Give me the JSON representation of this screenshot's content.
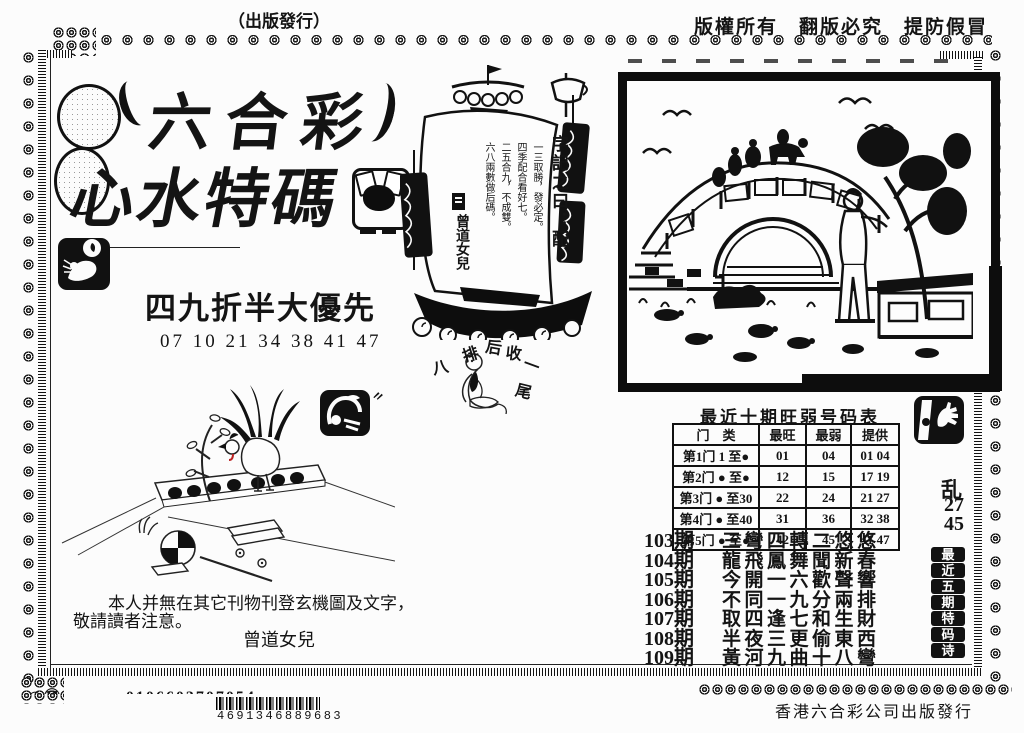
{
  "header": {
    "top_left": "（出版發行）",
    "top_right": "版權所有　翻版必究　提防假冒"
  },
  "masthead": {
    "title_line1": "六合彩",
    "title_line2": "心水特碼"
  },
  "promo": {
    "headline": "四九折半大優先",
    "numbers": "07 10 21 34 38 41 47"
  },
  "sail_message": {
    "heading": "字記之曰：配",
    "line1": "一三取勝，發必定。",
    "line2": "四季配合看好七。",
    "line3": "二五合九，不成雙。",
    "line4": "六八兩數做后碼。",
    "signature": "曾道女兒"
  },
  "mystic_chars": {
    "c1": "排",
    "c2": "后",
    "c3": "收",
    "c4": "八",
    "c5": "一",
    "c6": "尾"
  },
  "hot_cold_table": {
    "title": "最近十期旺弱号码表",
    "col_category": "门　类",
    "col_hot": "最旺",
    "col_cold": "最弱",
    "col_offer": "提供",
    "rows": [
      {
        "label": "第1门 1 至●",
        "hot": "01",
        "cold": "04",
        "offer": "01 04"
      },
      {
        "label": "第2门 ● 至●",
        "hot": "12",
        "cold": "15",
        "offer": "17 19"
      },
      {
        "label": "第3门 ● 至30",
        "hot": "22",
        "cold": "24",
        "offer": "21 27"
      },
      {
        "label": "第4门 ● 至40",
        "hot": "31",
        "cold": "36",
        "offer": "32 38"
      },
      {
        "label": "第5门 ● 至●",
        "hot": "42",
        "cold": "45",
        "offer": "41 47"
      }
    ]
  },
  "side_panel": {
    "code_char": "乱",
    "num1": "27",
    "num2": "45",
    "vertical_title": "最近五期特码诗"
  },
  "poem_list": {
    "items": [
      {
        "issue": "103期",
        "verse": "三彎四轉二悠悠"
      },
      {
        "issue": "104期",
        "verse": "龍飛鳳舞聞新春"
      },
      {
        "issue": "105期",
        "verse": "今開一六歡聲響"
      },
      {
        "issue": "106期",
        "verse": "不同一九分兩排"
      },
      {
        "issue": "107期",
        "verse": "取四逢七和生財"
      },
      {
        "issue": "108期",
        "verse": "半夜三更偷東西"
      },
      {
        "issue": "109期",
        "verse": "黃河九曲十八彎"
      }
    ]
  },
  "notice": {
    "line1": "本人并無在其它刊物刊登玄機圖及文字，",
    "line2": "敬請讀者注意。",
    "signature": "曾道女兒"
  },
  "footer": {
    "cut_line": "◎㊙‥‥‥‥‥0106603707054‥‥‥",
    "barcode_number": "4691346889683",
    "publisher": "香港六合彩公司出版發行"
  },
  "colors": {
    "ink": "#141414",
    "paper": "#fcfcfc"
  }
}
